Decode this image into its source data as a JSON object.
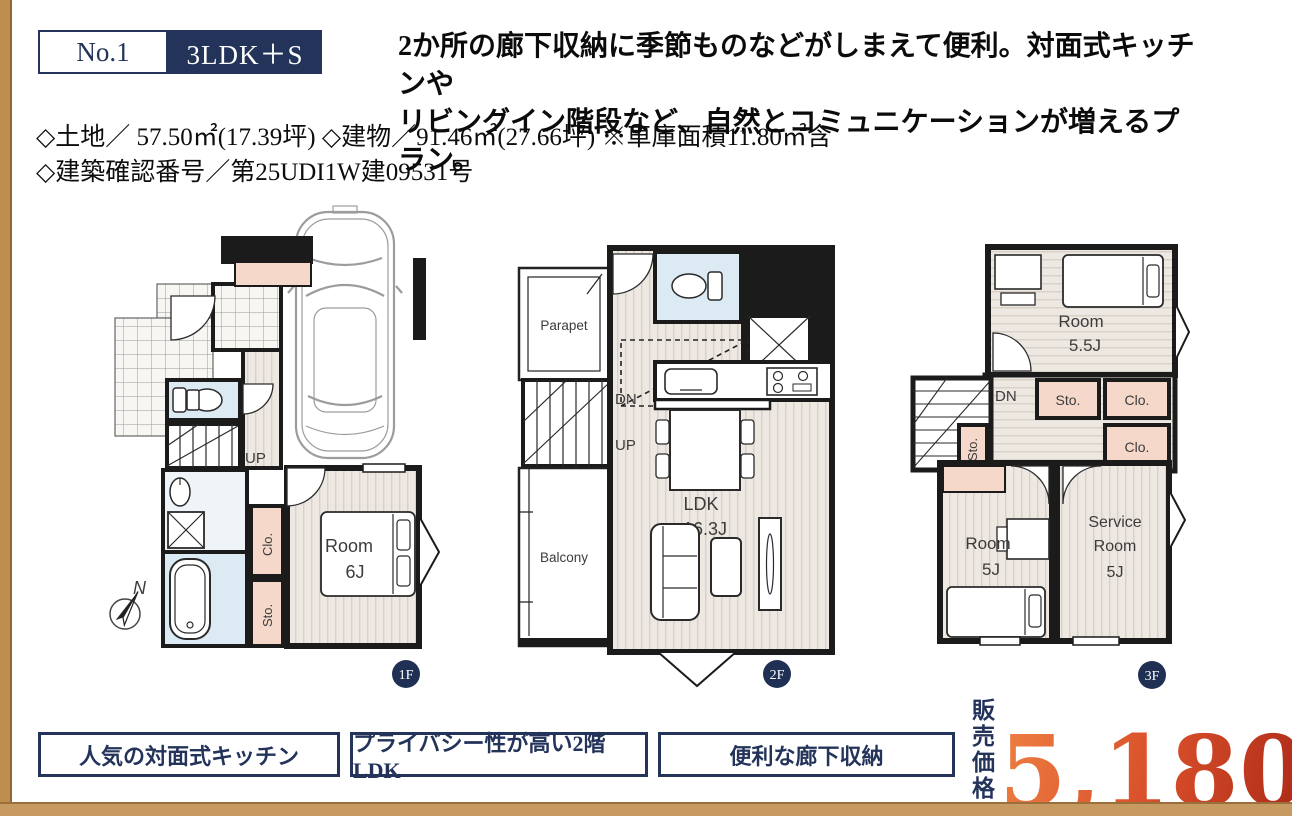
{
  "colors": {
    "accent_navy": "#23335a",
    "accent_tan": "#bf8d50",
    "price_gradient_start": "#ec7a40",
    "price_gradient_end": "#b02c1a",
    "storage_pink": "#f6d8ca",
    "wet_area_blue": "#dcebf3"
  },
  "header": {
    "plan_no": "No.1",
    "plan_type": "3LDK＋S",
    "description_line1": "2か所の廊下収納に季節ものなどがしまえて便利。対面式キッチンや",
    "description_line2": "リビングイン階段など、自然とコミュニケーションが増えるプラン。"
  },
  "property": {
    "line1": "◇土地／ 57.50㎡(17.39坪) ◇建物／91.46㎡(27.66坪) ※車庫面積11.80㎡含",
    "line2": "◇建築確認番号／第25UDI1W建09531号"
  },
  "floors": {
    "f1": {
      "badge": "1F",
      "labels": {
        "up": "UP",
        "room": "Room",
        "room_size": "6J",
        "clo": "Clo.",
        "sto": "Sto.",
        "compass_n": "N"
      }
    },
    "f2": {
      "badge": "2F",
      "labels": {
        "parapet": "Parapet",
        "dn": "DN",
        "up": "UP",
        "balcony": "Balcony",
        "ldk": "LDK",
        "ldk_size": "16.3J"
      }
    },
    "f3": {
      "badge": "3F",
      "labels": {
        "room1": "Room",
        "room1_size": "5.5J",
        "dn": "DN",
        "sto1": "Sto.",
        "clo1": "Clo.",
        "clo2": "Clo.",
        "sto2": "Sto.",
        "room2": "Room",
        "room2_size": "5J",
        "service_line1": "Service",
        "service_line2": "Room",
        "service_size": "5J"
      }
    }
  },
  "features": [
    {
      "label": "人気の対面式キッチン"
    },
    {
      "label": "プライバシー性が高い2階LDK"
    },
    {
      "label": "便利な廊下収納"
    }
  ],
  "price": {
    "prefix_line1": "販売",
    "prefix_line2": "価格",
    "amount": "5,180",
    "tax_note": "(税込)",
    "unit": "万円"
  }
}
